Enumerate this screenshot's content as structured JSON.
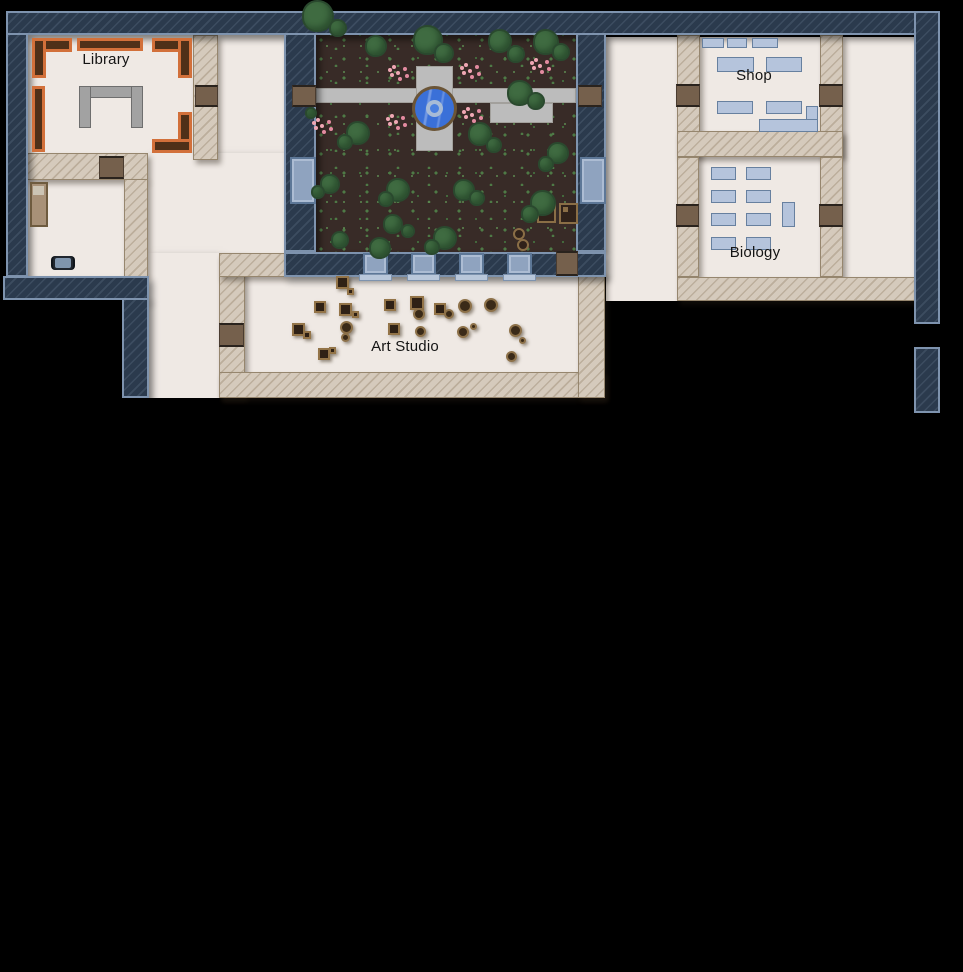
{
  "rooms": {
    "library": "Library",
    "shop": "Shop",
    "biology": "Biology",
    "art_studio": "Art Studio"
  },
  "palette": {
    "background": "#000000",
    "floor": "#efe9e4",
    "exterior_wall": "#2b3a4d",
    "exterior_wall_border": "#7e93ae",
    "interior_wall": "#d5cabc",
    "door": "#75604c",
    "window": "#8fa3bf",
    "bookshelf_orange": "#d2703a",
    "soil": "#382b27",
    "tree": "#3f6b41",
    "path": "#bcbcbc",
    "fountain_water": "#3a70d8",
    "fountain_ring": "#6b5537",
    "furniture_blue": "#b5c4dc",
    "flower_pink": "#f0a7b4"
  },
  "map": {
    "floors": [
      {
        "x": 28,
        "y": 35,
        "w": 166,
        "h": 120
      },
      {
        "x": 218,
        "y": 35,
        "w": 66,
        "h": 218
      },
      {
        "x": 148,
        "y": 153,
        "w": 136,
        "h": 100
      },
      {
        "x": 148,
        "y": 253,
        "w": 71,
        "h": 145
      },
      {
        "x": 28,
        "y": 179,
        "w": 96,
        "h": 98
      },
      {
        "x": 243,
        "y": 275,
        "w": 335,
        "h": 98
      },
      {
        "x": 606,
        "y": 37,
        "w": 71,
        "h": 264
      },
      {
        "x": 699,
        "y": 37,
        "w": 121,
        "h": 95
      },
      {
        "x": 699,
        "y": 157,
        "w": 121,
        "h": 120
      },
      {
        "x": 843,
        "y": 37,
        "w": 71,
        "h": 240
      }
    ],
    "navy_walls": [
      {
        "x": 6,
        "y": 11,
        "w": 934,
        "h": 24
      },
      {
        "x": 6,
        "y": 33,
        "w": 22,
        "h": 244
      },
      {
        "x": 3,
        "y": 276,
        "w": 146,
        "h": 24
      },
      {
        "x": 122,
        "y": 298,
        "w": 27,
        "h": 100
      },
      {
        "x": 284,
        "y": 33,
        "w": 32,
        "h": 219
      },
      {
        "x": 576,
        "y": 33,
        "w": 30,
        "h": 219
      },
      {
        "x": 284,
        "y": 252,
        "w": 322,
        "h": 25
      },
      {
        "x": 914,
        "y": 11,
        "w": 26,
        "h": 313
      },
      {
        "x": 914,
        "y": 347,
        "w": 26,
        "h": 66
      }
    ],
    "tan_walls": [
      {
        "x": 193,
        "y": 35,
        "w": 25,
        "h": 125
      },
      {
        "x": 26,
        "y": 153,
        "w": 122,
        "h": 27
      },
      {
        "x": 124,
        "y": 179,
        "w": 24,
        "h": 98
      },
      {
        "x": 219,
        "y": 253,
        "w": 26,
        "h": 145
      },
      {
        "x": 219,
        "y": 253,
        "w": 67,
        "h": 24
      },
      {
        "x": 219,
        "y": 372,
        "w": 386,
        "h": 26
      },
      {
        "x": 578,
        "y": 273,
        "w": 27,
        "h": 125
      },
      {
        "x": 677,
        "y": 35,
        "w": 23,
        "h": 122
      },
      {
        "x": 820,
        "y": 35,
        "w": 23,
        "h": 122
      },
      {
        "x": 677,
        "y": 131,
        "w": 166,
        "h": 26
      },
      {
        "x": 677,
        "y": 157,
        "w": 22,
        "h": 120
      },
      {
        "x": 820,
        "y": 157,
        "w": 23,
        "h": 120
      },
      {
        "x": 677,
        "y": 277,
        "w": 240,
        "h": 24
      }
    ],
    "doors": [
      {
        "x": 195,
        "y": 85,
        "w": 23,
        "h": 22
      },
      {
        "x": 99,
        "y": 156,
        "w": 25,
        "h": 23
      },
      {
        "x": 292,
        "y": 85,
        "w": 24,
        "h": 22
      },
      {
        "x": 578,
        "y": 85,
        "w": 24,
        "h": 22
      },
      {
        "x": 556,
        "y": 251,
        "w": 22,
        "h": 25
      },
      {
        "x": 219,
        "y": 323,
        "w": 25,
        "h": 24
      },
      {
        "x": 676,
        "y": 84,
        "w": 24,
        "h": 23
      },
      {
        "x": 819,
        "y": 84,
        "w": 24,
        "h": 23
      },
      {
        "x": 676,
        "y": 204,
        "w": 23,
        "h": 23
      },
      {
        "x": 819,
        "y": 204,
        "w": 24,
        "h": 23
      }
    ],
    "windows": [
      {
        "x": 290,
        "y": 157,
        "w": 26,
        "h": 47
      },
      {
        "x": 580,
        "y": 157,
        "w": 26,
        "h": 47
      },
      {
        "x": 363,
        "y": 253,
        "w": 25,
        "h": 22
      },
      {
        "x": 411,
        "y": 253,
        "w": 25,
        "h": 22
      },
      {
        "x": 459,
        "y": 253,
        "w": 25,
        "h": 22
      },
      {
        "x": 507,
        "y": 253,
        "w": 25,
        "h": 22
      }
    ],
    "window_sills": [
      {
        "x": 359,
        "y": 274,
        "w": 33,
        "h": 7
      },
      {
        "x": 407,
        "y": 274,
        "w": 33,
        "h": 7
      },
      {
        "x": 455,
        "y": 274,
        "w": 33,
        "h": 7
      },
      {
        "x": 503,
        "y": 274,
        "w": 33,
        "h": 7
      }
    ],
    "courtyard": {
      "soil": {
        "x": 316,
        "y": 33,
        "w": 260,
        "h": 219
      },
      "path": [
        {
          "x": 316,
          "y": 88,
          "w": 260,
          "h": 15
        },
        {
          "x": 416,
          "y": 66,
          "w": 37,
          "h": 85
        },
        {
          "x": 490,
          "y": 103,
          "w": 63,
          "h": 20
        }
      ],
      "fountain": {
        "x": 412,
        "y": 86,
        "d": 45
      },
      "trees": [
        {
          "cx": 318,
          "cy": 16,
          "r": 16
        },
        {
          "cx": 338,
          "cy": 28,
          "r": 9
        },
        {
          "cx": 376,
          "cy": 46,
          "r": 11
        },
        {
          "cx": 428,
          "cy": 40,
          "r": 15
        },
        {
          "cx": 444,
          "cy": 53,
          "r": 10
        },
        {
          "cx": 500,
          "cy": 41,
          "r": 12
        },
        {
          "cx": 516,
          "cy": 54,
          "r": 9
        },
        {
          "cx": 546,
          "cy": 42,
          "r": 13
        },
        {
          "cx": 561,
          "cy": 52,
          "r": 9
        },
        {
          "cx": 520,
          "cy": 93,
          "r": 13
        },
        {
          "cx": 536,
          "cy": 101,
          "r": 9
        },
        {
          "cx": 311,
          "cy": 113,
          "r": 6
        },
        {
          "cx": 358,
          "cy": 133,
          "r": 12
        },
        {
          "cx": 345,
          "cy": 142,
          "r": 8
        },
        {
          "cx": 480,
          "cy": 134,
          "r": 12
        },
        {
          "cx": 494,
          "cy": 145,
          "r": 8
        },
        {
          "cx": 558,
          "cy": 153,
          "r": 11
        },
        {
          "cx": 546,
          "cy": 164,
          "r": 8
        },
        {
          "cx": 330,
          "cy": 184,
          "r": 10
        },
        {
          "cx": 318,
          "cy": 192,
          "r": 7
        },
        {
          "cx": 398,
          "cy": 190,
          "r": 12
        },
        {
          "cx": 386,
          "cy": 199,
          "r": 8
        },
        {
          "cx": 464,
          "cy": 190,
          "r": 11
        },
        {
          "cx": 477,
          "cy": 198,
          "r": 8
        },
        {
          "cx": 543,
          "cy": 203,
          "r": 13
        },
        {
          "cx": 530,
          "cy": 214,
          "r": 9
        },
        {
          "cx": 393,
          "cy": 224,
          "r": 10
        },
        {
          "cx": 408,
          "cy": 231,
          "r": 7
        },
        {
          "cx": 445,
          "cy": 238,
          "r": 12
        },
        {
          "cx": 432,
          "cy": 247,
          "r": 8
        },
        {
          "cx": 380,
          "cy": 248,
          "r": 11
        },
        {
          "cx": 340,
          "cy": 240,
          "r": 9
        }
      ],
      "flowers": [
        {
          "cx": 398,
          "cy": 73
        },
        {
          "cx": 470,
          "cy": 71
        },
        {
          "cx": 540,
          "cy": 66
        },
        {
          "cx": 472,
          "cy": 115
        },
        {
          "cx": 396,
          "cy": 122
        },
        {
          "cx": 322,
          "cy": 126
        }
      ],
      "crates": [
        {
          "x": 537,
          "y": 203,
          "w": 19,
          "h": 20
        },
        {
          "x": 559,
          "y": 203,
          "w": 19,
          "h": 21
        }
      ],
      "pots": [
        {
          "cx": 519,
          "cy": 234,
          "r": 6
        },
        {
          "cx": 523,
          "cy": 245,
          "r": 6
        }
      ]
    },
    "library": {
      "shelves": [
        {
          "x": 32,
          "y": 38,
          "w": 40,
          "h": 14
        },
        {
          "x": 32,
          "y": 38,
          "w": 14,
          "h": 40
        },
        {
          "x": 77,
          "y": 38,
          "w": 66,
          "h": 13
        },
        {
          "x": 152,
          "y": 38,
          "w": 40,
          "h": 14
        },
        {
          "x": 178,
          "y": 38,
          "w": 14,
          "h": 40
        },
        {
          "x": 32,
          "y": 86,
          "w": 13,
          "h": 66
        },
        {
          "x": 178,
          "y": 112,
          "w": 14,
          "h": 41
        },
        {
          "x": 152,
          "y": 139,
          "w": 40,
          "h": 14
        }
      ],
      "desk": [
        {
          "x": 79,
          "y": 86,
          "w": 64,
          "h": 12
        },
        {
          "x": 79,
          "y": 86,
          "w": 12,
          "h": 42
        },
        {
          "x": 131,
          "y": 86,
          "w": 12,
          "h": 42
        }
      ]
    },
    "dorm": {
      "bed": {
        "x": 30,
        "y": 182,
        "w": 18,
        "h": 45
      },
      "cart": {
        "x": 53,
        "y": 256,
        "w": 20,
        "h": 14
      }
    },
    "shop": {
      "tables": [
        {
          "x": 702,
          "y": 38,
          "w": 22,
          "h": 10
        },
        {
          "x": 727,
          "y": 38,
          "w": 20,
          "h": 10
        },
        {
          "x": 752,
          "y": 38,
          "w": 26,
          "h": 10
        },
        {
          "x": 717,
          "y": 57,
          "w": 37,
          "h": 15
        },
        {
          "x": 766,
          "y": 57,
          "w": 36,
          "h": 15
        },
        {
          "x": 717,
          "y": 101,
          "w": 36,
          "h": 13
        },
        {
          "x": 766,
          "y": 101,
          "w": 36,
          "h": 13
        },
        {
          "x": 759,
          "y": 119,
          "w": 59,
          "h": 13
        },
        {
          "x": 806,
          "y": 106,
          "w": 12,
          "h": 14
        }
      ]
    },
    "biology": {
      "desks": [
        {
          "x": 711,
          "y": 167,
          "w": 25,
          "h": 13
        },
        {
          "x": 746,
          "y": 167,
          "w": 25,
          "h": 13
        },
        {
          "x": 711,
          "y": 190,
          "w": 25,
          "h": 13
        },
        {
          "x": 746,
          "y": 190,
          "w": 25,
          "h": 13
        },
        {
          "x": 711,
          "y": 213,
          "w": 25,
          "h": 13
        },
        {
          "x": 746,
          "y": 213,
          "w": 25,
          "h": 13
        },
        {
          "x": 711,
          "y": 237,
          "w": 25,
          "h": 13
        },
        {
          "x": 746,
          "y": 237,
          "w": 25,
          "h": 13
        },
        {
          "x": 782,
          "y": 202,
          "w": 13,
          "h": 25
        }
      ]
    },
    "art_studio": {
      "easels": [
        {
          "x": 336,
          "y": 276,
          "s": 13
        },
        {
          "x": 347,
          "y": 288,
          "s": 7
        },
        {
          "x": 314,
          "y": 301,
          "s": 12
        },
        {
          "x": 339,
          "y": 303,
          "s": 13
        },
        {
          "x": 352,
          "y": 311,
          "s": 7
        },
        {
          "x": 384,
          "y": 299,
          "s": 12
        },
        {
          "x": 410,
          "y": 296,
          "s": 14
        },
        {
          "x": 434,
          "y": 303,
          "s": 12
        },
        {
          "x": 292,
          "y": 323,
          "s": 13
        },
        {
          "x": 303,
          "y": 331,
          "s": 8
        },
        {
          "x": 388,
          "y": 323,
          "s": 12
        },
        {
          "x": 318,
          "y": 348,
          "s": 12
        },
        {
          "x": 329,
          "y": 347,
          "s": 7
        }
      ],
      "stools": [
        {
          "x": 458,
          "y": 299,
          "d": 14
        },
        {
          "x": 484,
          "y": 298,
          "d": 14
        },
        {
          "x": 413,
          "y": 308,
          "d": 12
        },
        {
          "x": 444,
          "y": 309,
          "d": 10
        },
        {
          "x": 340,
          "y": 321,
          "d": 13
        },
        {
          "x": 341,
          "y": 333,
          "d": 9
        },
        {
          "x": 415,
          "y": 326,
          "d": 11
        },
        {
          "x": 457,
          "y": 326,
          "d": 12
        },
        {
          "x": 470,
          "y": 323,
          "d": 7
        },
        {
          "x": 509,
          "y": 324,
          "d": 13
        },
        {
          "x": 519,
          "y": 337,
          "d": 7
        },
        {
          "x": 506,
          "y": 351,
          "d": 11
        }
      ]
    }
  }
}
